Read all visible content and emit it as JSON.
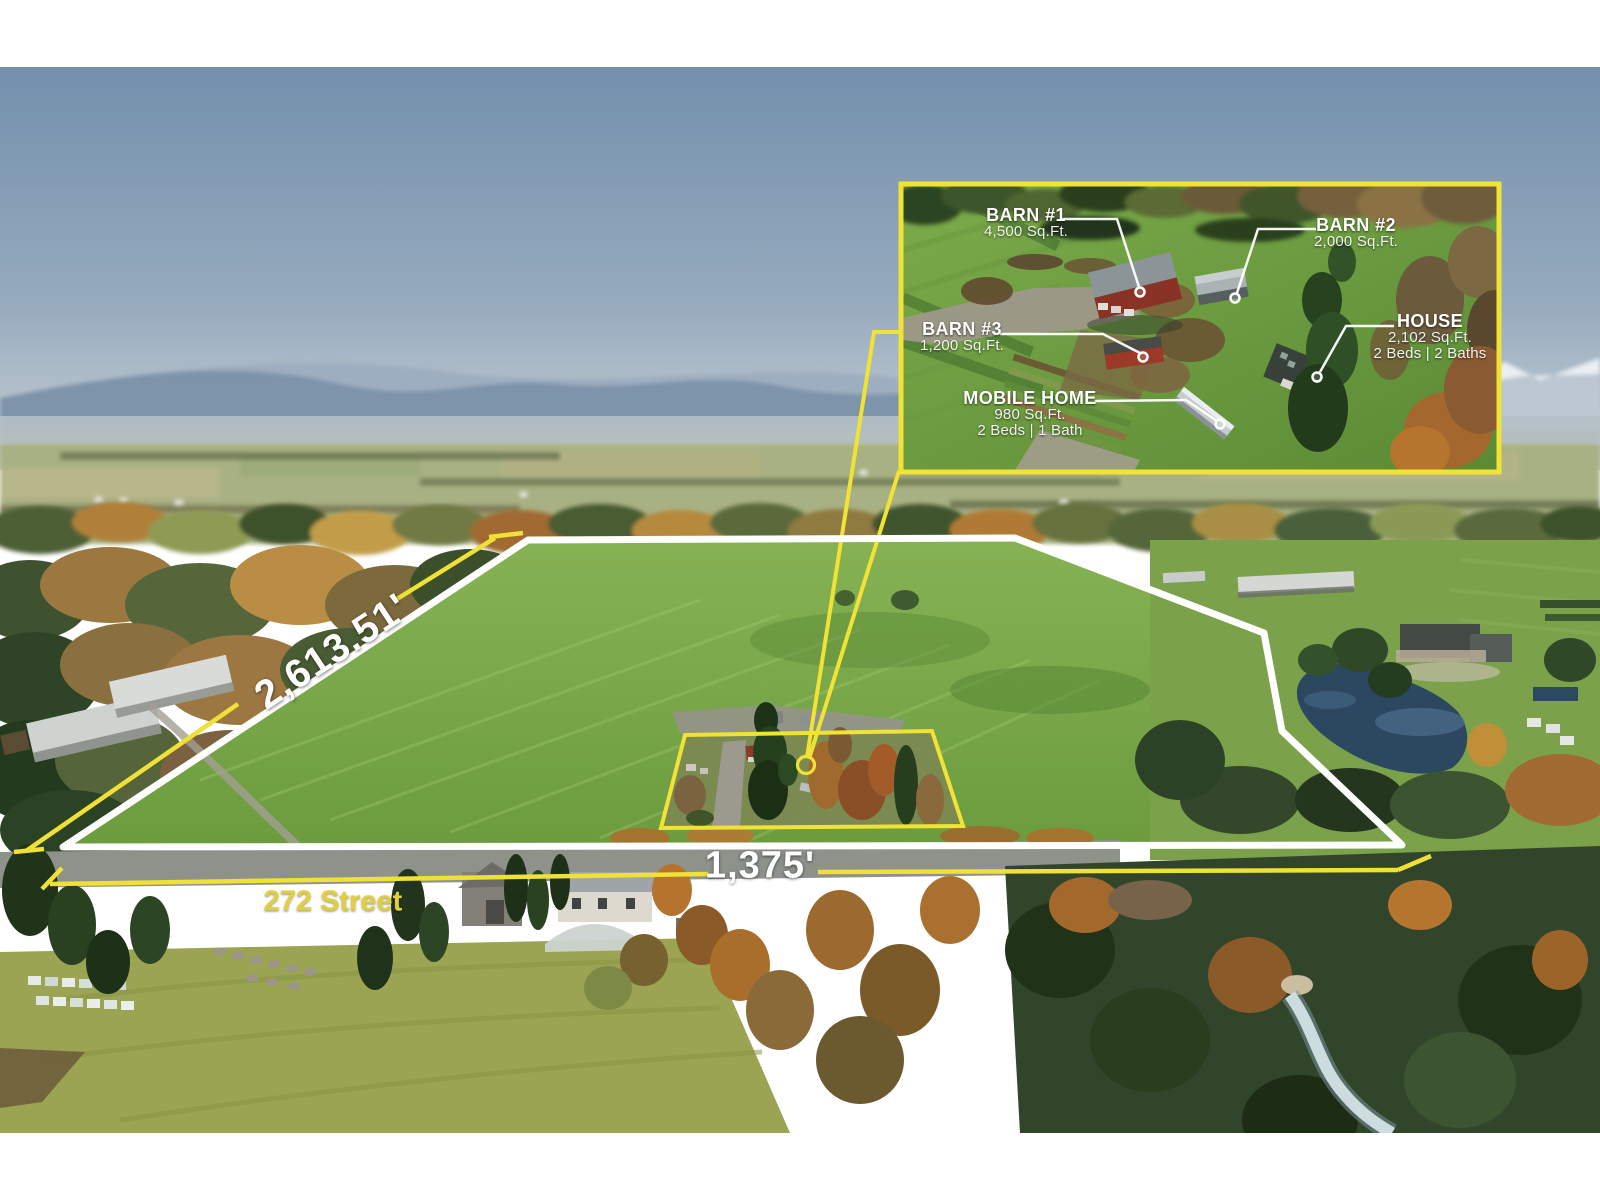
{
  "annotations": {
    "side_dimension": "2,613.51'",
    "frontage_dimension": "1,375'",
    "street": "272 Street"
  },
  "inset_callouts": {
    "barn1": {
      "name": "BARN #1",
      "area": "4,500 Sq.Ft."
    },
    "barn2": {
      "name": "BARN #2",
      "area": "2,000 Sq.Ft."
    },
    "barn3": {
      "name": "BARN #3",
      "area": "1,200 Sq.Ft."
    },
    "house": {
      "name": "HOUSE",
      "area": "2,102 Sq.Ft.",
      "rooms": "2 Beds | 2 Baths"
    },
    "mobile_home": {
      "name": "MOBILE HOME",
      "area": "980 Sq.Ft.",
      "rooms": "2 Beds | 1 Bath"
    }
  },
  "colors": {
    "accent_yellow": "#F1E335",
    "boundary_white": "#FFFFFF"
  }
}
